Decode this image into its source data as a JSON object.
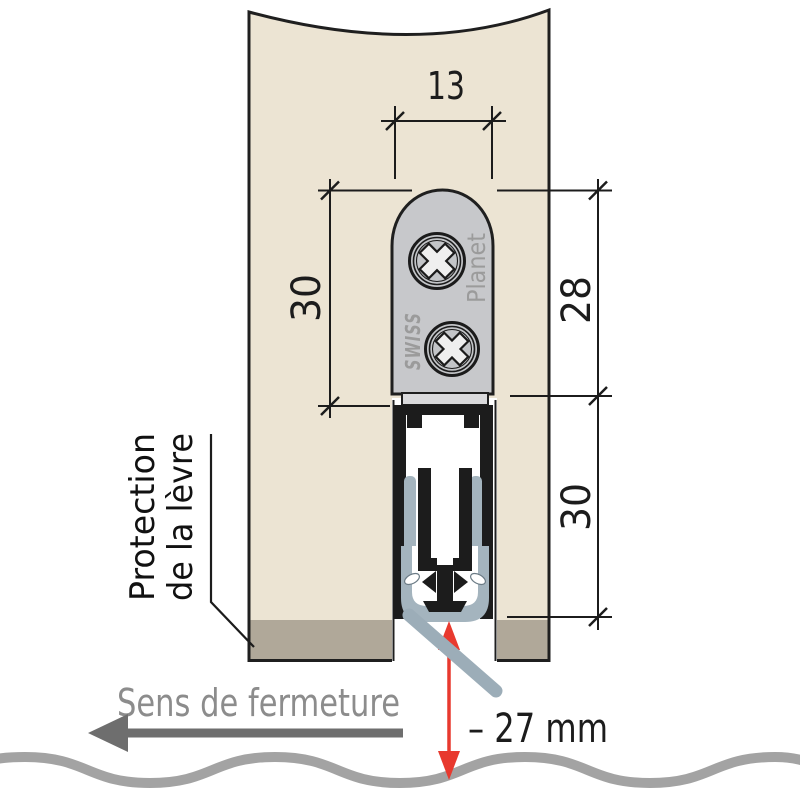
{
  "diagram": {
    "dimensions": {
      "top_width": "13",
      "left_height": "30",
      "right_upper_height": "28",
      "right_lower_height": "30",
      "floor_clearance": "– 27 mm"
    },
    "labels": {
      "lip_protection_line1": "Protection",
      "lip_protection_line2": "de la lèvre",
      "closing_direction": "Sens de fermeture"
    },
    "brand": {
      "word_left": "SWISS",
      "word_right": "Planet"
    },
    "colors": {
      "door_panel": "#ece4d3",
      "door_bottom_band": "#b0a899",
      "faceplate_gray": "#c7c8cb",
      "rubber_blue_gray": "#a4b4be",
      "profile_black": "#1c1c1c",
      "clearance_arrow_red": "#e8392e",
      "floor_wave_gray": "#a3a3a3",
      "direction_text_gray": "#8c8c8c",
      "direction_arrow_gray": "#6e6e6e",
      "brand_text_gray": "#9b9b9b"
    }
  }
}
